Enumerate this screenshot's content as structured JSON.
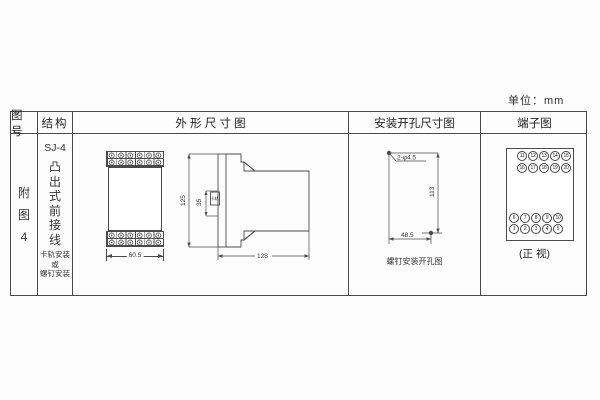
{
  "unit_label": "单位：mm",
  "table": {
    "headers": {
      "figure_no": "图号",
      "structure": "结构",
      "outline": "外 形 尺 寸 图",
      "mounting": "安装开孔尺寸图",
      "terminal": "端子图"
    },
    "figure_no": {
      "line1": "附",
      "line2": "图",
      "line3": "4"
    },
    "structure": {
      "model": "SJ-4",
      "type_vertical": [
        "凸",
        "出",
        "式",
        "前",
        "接",
        "线"
      ],
      "mount_note": [
        "卡轨安装",
        "或",
        "螺钉安装"
      ]
    }
  },
  "outline": {
    "front_width": "60.5",
    "side_height": "125",
    "rail_width": "35",
    "rail_label": "卡轨",
    "side_depth": "128"
  },
  "mounting": {
    "holes": "2-φ4.5",
    "vertical_spacing": "113",
    "horizontal_spacing": "48.5",
    "caption": "螺钉安装开孔图"
  },
  "terminal": {
    "rows_top": [
      [
        "11",
        "12",
        "13",
        "14",
        "15"
      ],
      [
        "16",
        "17",
        "18",
        "19",
        "20"
      ]
    ],
    "rows_bottom": [
      [
        "6",
        "7",
        "8",
        "9",
        "10"
      ],
      [
        "1",
        "2",
        "3",
        "4",
        "5"
      ]
    ],
    "caption": "(正 视)"
  }
}
